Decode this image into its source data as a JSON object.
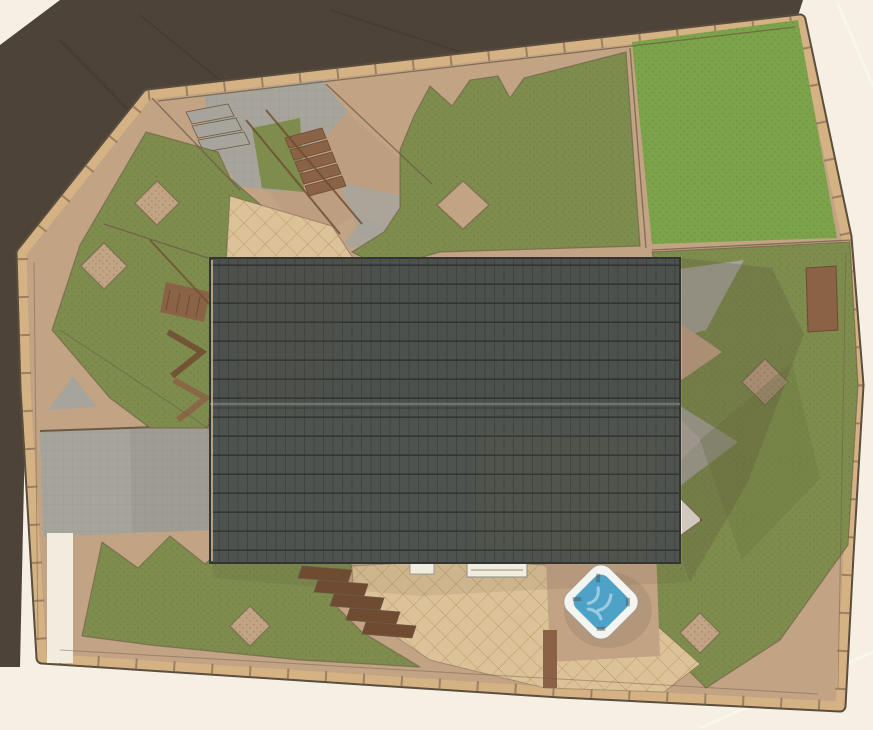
{
  "palette": {
    "paper": "#f6efe3",
    "paper_light": "#fcf8f1",
    "shadow_dark": "#4e4339",
    "shadow_streak": "#453a30",
    "boundary_tan": "#d4b284",
    "boundary_line": "#5b4e3e",
    "base_tan": "#c2a384",
    "tan_dark": "#a98b70",
    "path_line": "#6b5a46",
    "lawn_green": "#7ba44a",
    "olive_green": "#7e8c4d",
    "olive_dark": "#66743e",
    "gray_pave": "#a7a49b",
    "gray_dark": "#8e8b82",
    "white_path": "#f2ecdf",
    "deck_light": "#dcc298",
    "deck_line": "#b28e5e",
    "wood_dark": "#6e4b31",
    "wood_mid": "#8a6245",
    "roof_base": "#4f534f",
    "roof_line_v": "#414440",
    "roof_line_h": "#323531",
    "roof_ridge": "#737872",
    "roof_stain": "#6a5540",
    "tub_rim": "#f4f4f0",
    "tub_water": "#4fa2c7",
    "tub_water_light": "#a6d4e4"
  },
  "legend": {
    "paper_background": "paper",
    "offsite_shadow": "shadow_dark",
    "site_border": "boundary_tan",
    "paving": "base_tan",
    "concrete": "gray_pave",
    "lawn": "lawn_green",
    "garden_beds": "olive_green",
    "decking": "deck_light",
    "wood_steps": "wood_dark",
    "house_roof": "roof_base",
    "hot_tub_water": "tub_water"
  }
}
